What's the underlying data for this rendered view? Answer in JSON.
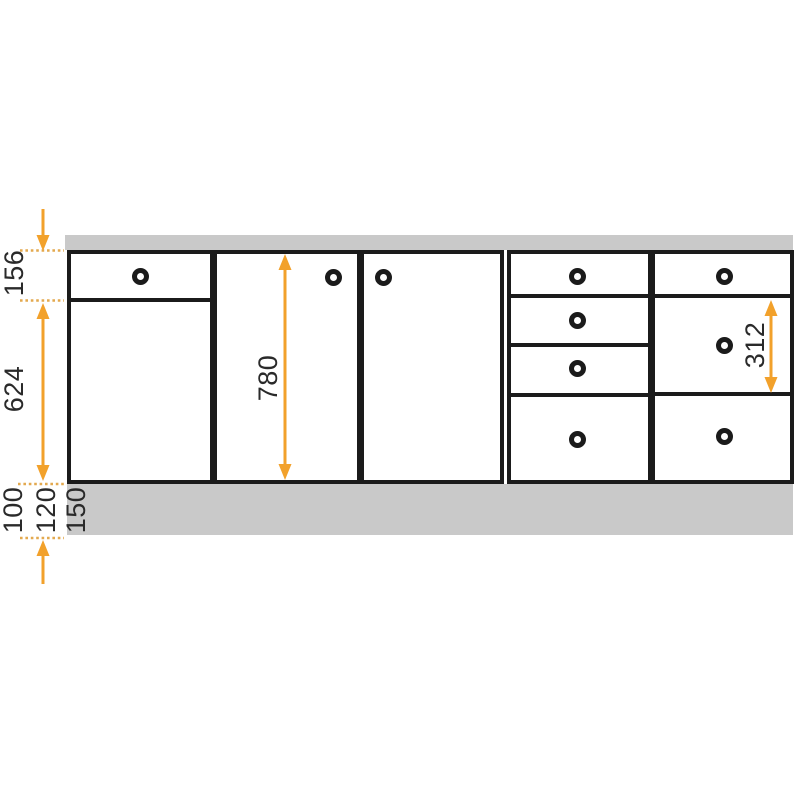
{
  "diagram": {
    "title": "kitchen-cabinet-front-elevation",
    "labels": {
      "top_drawer_height": "156",
      "door_height": "624",
      "plinth_height_option_1": "100",
      "plinth_height_option_2": "120",
      "plinth_height_option_3": "150",
      "total_front_height": "780",
      "middle_front_height": "312"
    },
    "colors": {
      "dimension_orange": "#F2A12B",
      "dash_orange": "#E3A94F",
      "band_gray": "#C9C9C9",
      "outline_black": "#1B1B1B"
    }
  }
}
